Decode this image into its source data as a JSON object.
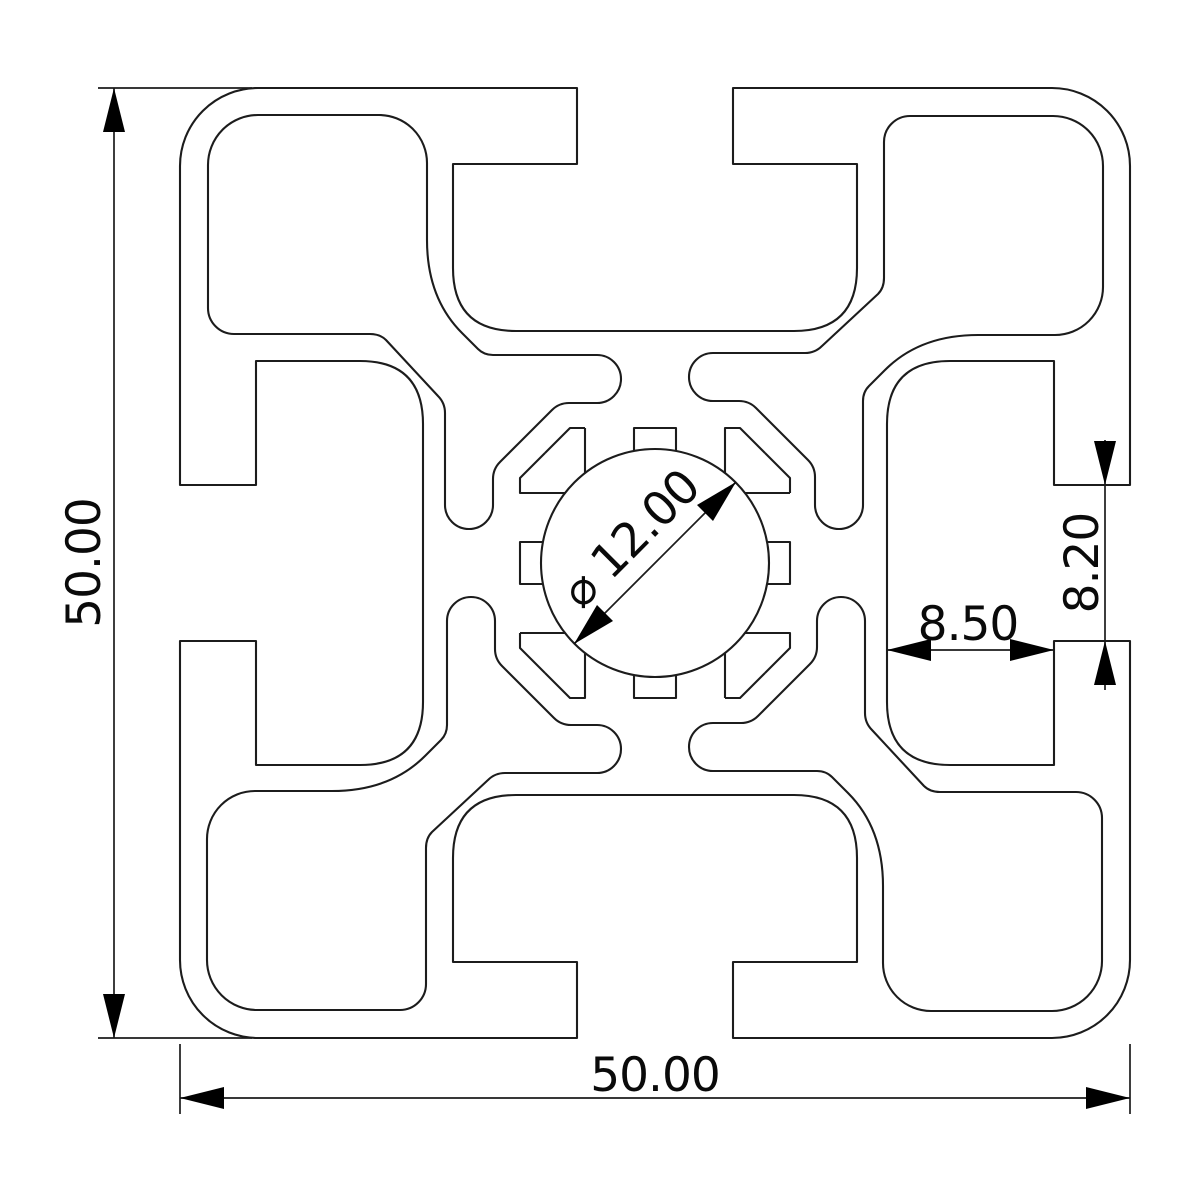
{
  "drawing": {
    "type": "technical cross-section",
    "subject": "aluminium extrusion profile 50x50 with four T-slots and central bore",
    "line_color": "#1c1c1c",
    "background": "#ffffff",
    "dimensions": {
      "overall_height": "50.00",
      "overall_width": "50.00",
      "slot_opening": "8.20",
      "slot_depth": "8.50",
      "center_bore": "⌀ 12.00"
    }
  }
}
